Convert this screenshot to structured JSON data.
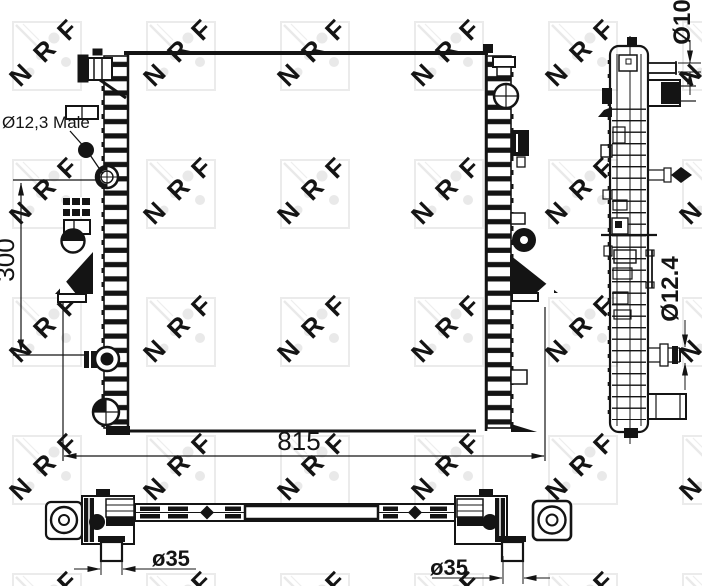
{
  "drawing": {
    "brand_watermark": "NRF",
    "watermark_letters": [
      "N",
      "R",
      "F"
    ],
    "labels": {
      "inlet_port": "Ø12,3 Male",
      "height_dim": "300",
      "width_dim": "815",
      "top_pipe_dim": "Ø10",
      "drain_dim": "Ø12.4",
      "left_pipe_dim": "ø35",
      "right_pipe_dim": "ø35"
    },
    "colors": {
      "line": "#141414",
      "watermark": "#e9e9e9",
      "background": "#ffffff"
    }
  }
}
